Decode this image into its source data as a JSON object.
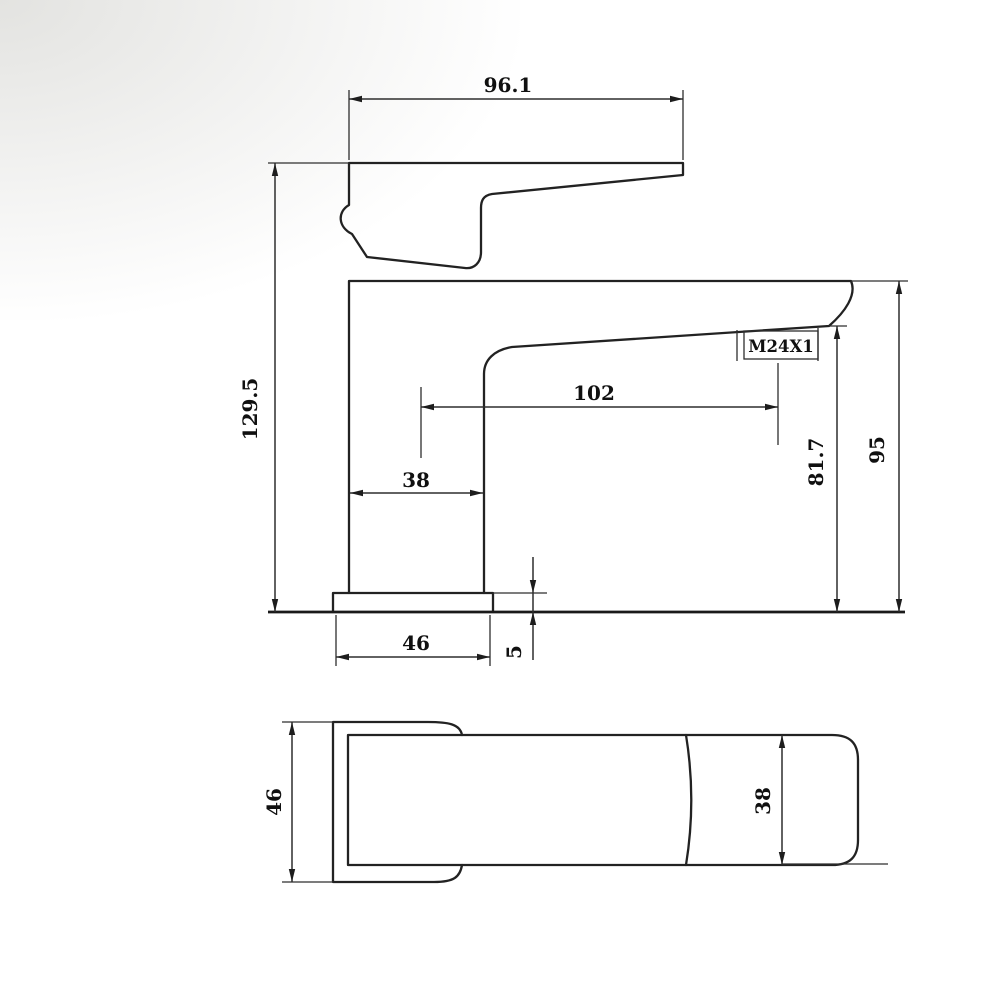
{
  "page": {
    "background_color": "#ffffff",
    "line_color": "#1f1f1f",
    "paper_tint_color": "#e9e9e7"
  },
  "drawing": {
    "front_view": {
      "dims": {
        "handle_length": "96.1",
        "overall_height": "129.5",
        "spout_reach": "102",
        "body_width": "38",
        "outlet_thread": "M24X1",
        "outlet_height": "81.7",
        "body_height": "95",
        "base_width": "46",
        "base_thickness": "5"
      }
    },
    "plan_view": {
      "dims": {
        "base_depth": "46",
        "handle_width": "38"
      }
    }
  }
}
